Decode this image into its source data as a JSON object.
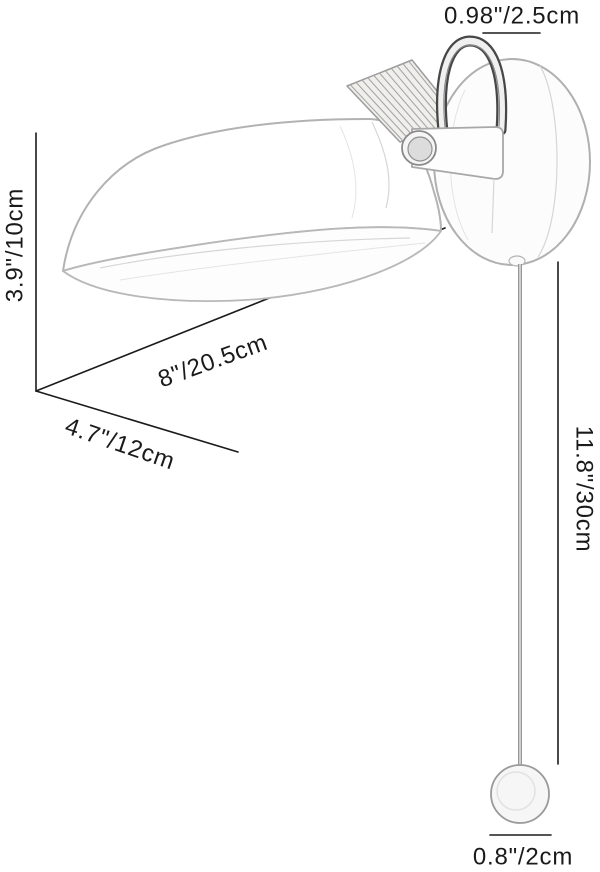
{
  "diagram": {
    "title": "wall lamp dimension diagram",
    "type": "product-dimension-diagram",
    "labels": {
      "hook_width": "0.98\"/2.5cm",
      "shade_height": "3.9\"/10cm",
      "shade_length": "8\"/20.5cm",
      "shade_width": "4.7\"/12cm",
      "cord_length": "11.8\"/30cm",
      "knob_diameter": "0.8\"/2cm"
    },
    "colors": {
      "background": "#ffffff",
      "dimension_line": "#1b1b1b",
      "label_text": "#1a1a1a",
      "sketch_outline": "#b2b2b2",
      "sketch_dark": "#4a4a4a",
      "wood_hatch": "#a6a6a6"
    }
  }
}
